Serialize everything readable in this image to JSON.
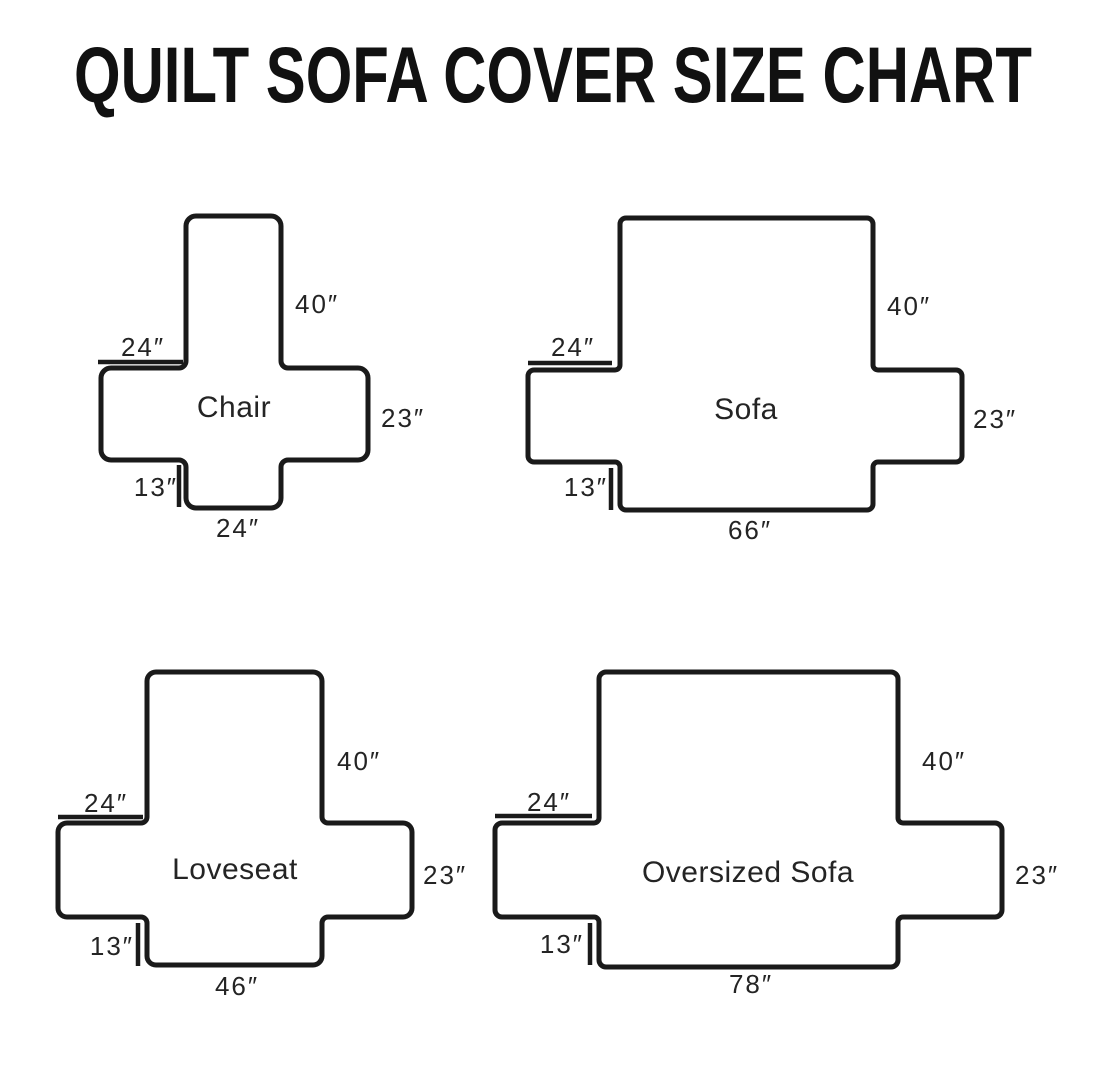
{
  "title": "QUILT SOFA COVER SIZE CHART",
  "colors": {
    "line": "#1a1a1a",
    "background": "#ffffff",
    "text": "#242424"
  },
  "diagrams": [
    {
      "name": "Chair",
      "back_height": "40″",
      "arm_top_width": "24″",
      "side_height": "23″",
      "front_drop": "13″",
      "bottom_width": "24″"
    },
    {
      "name": "Sofa",
      "back_height": "40″",
      "arm_top_width": "24″",
      "side_height": "23″",
      "front_drop": "13″",
      "bottom_width": "66″"
    },
    {
      "name": "Loveseat",
      "back_height": "40″",
      "arm_top_width": "24″",
      "side_height": "23″",
      "front_drop": "13″",
      "bottom_width": "46″"
    },
    {
      "name": "Oversized Sofa",
      "back_height": "40″",
      "arm_top_width": "24″",
      "side_height": "23″",
      "front_drop": "13″",
      "bottom_width": "78″"
    }
  ]
}
